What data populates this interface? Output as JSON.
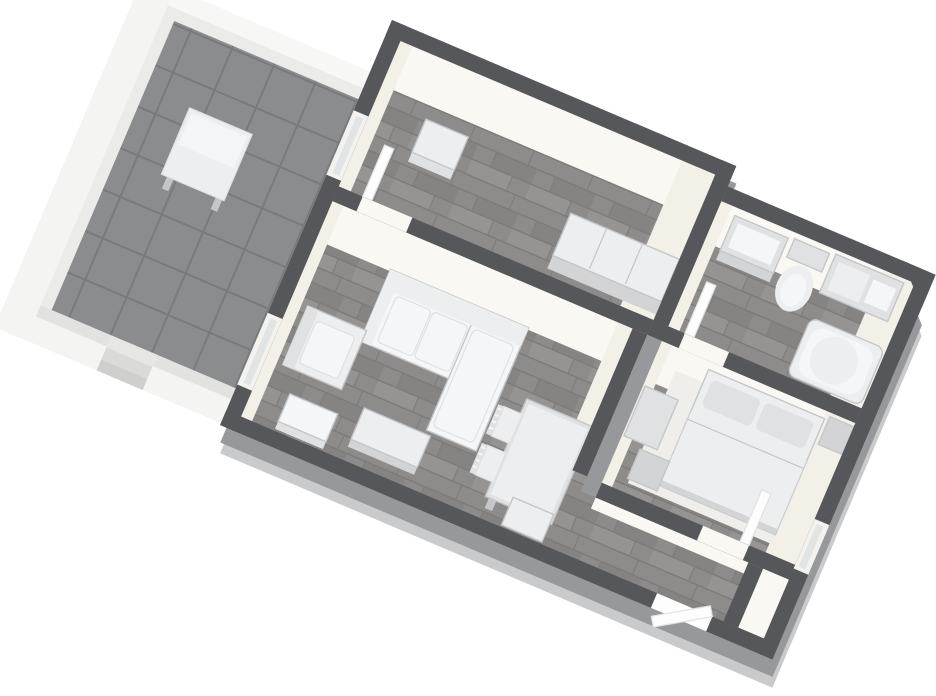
{
  "scene": {
    "type": "floor-plan-3d-render",
    "view": "rotated-top-down",
    "rotation_deg": 23,
    "rooms": [
      {
        "name": "terrace",
        "floor": "gray-tile",
        "furniture": [
          "outdoor-table"
        ]
      },
      {
        "name": "upper-room",
        "floor": "dark-wood",
        "furniture": [
          "storage-box",
          "wardrobe"
        ]
      },
      {
        "name": "bathroom",
        "floor": "dark-wood",
        "furniture": [
          "sink-cabinet",
          "toilet",
          "vanity-counter",
          "bathtub"
        ]
      },
      {
        "name": "living-dining-room",
        "floor": "dark-wood",
        "furniture": [
          "sectional-sofa",
          "armchair",
          "coffee-table",
          "dining-table",
          "dining-chair",
          "dining-chair",
          "sideboard",
          "storage-cube"
        ]
      },
      {
        "name": "bedroom",
        "floor": "dark-wood",
        "furniture": [
          "double-bed",
          "pillows",
          "nightstand",
          "dresser",
          "bed-bench"
        ]
      },
      {
        "name": "hallway",
        "floor": "dark-wood",
        "furniture": []
      }
    ],
    "openings": [
      "terrace-door",
      "upper-room-window",
      "upper-room-door",
      "bathroom-door",
      "bedroom-door",
      "bedroom-window",
      "entry-door"
    ]
  },
  "palette": {
    "bg": "#ffffff",
    "wall-dark": "#56575a",
    "wall-side": "#97989b",
    "wall-side-soft": "#c9cacb",
    "wall-face": "#f3f0e8",
    "wall-face-lt": "#faf8f2",
    "floor-base": "#8d8c8a",
    "floor-lt": "#959492",
    "floor-dk": "#858482",
    "floor-line": "#7d7c7a",
    "tile-base": "#8b8c8e",
    "tile-line": "#797a7d",
    "parapet": "#ebebe9",
    "parapet-dk": "#e2e2e0",
    "skirt": "#f4f4f2",
    "skirt-lt": "#f7f7f5",
    "step-1": "#e6e6e4",
    "step-2": "#dadad8",
    "step-3": "#cfcfcd",
    "furn-bright": "#f5f6f7",
    "furn-light": "#eceef0",
    "furn-mid": "#dfe1e3",
    "furn-deep": "#d2d4d6",
    "furn-edge": "#c4c6c9",
    "rug": "#efeeea",
    "glass": "#e0e4e5",
    "door-frame": "#f3f2ef",
    "door-leaf": "#fdfdfd"
  }
}
